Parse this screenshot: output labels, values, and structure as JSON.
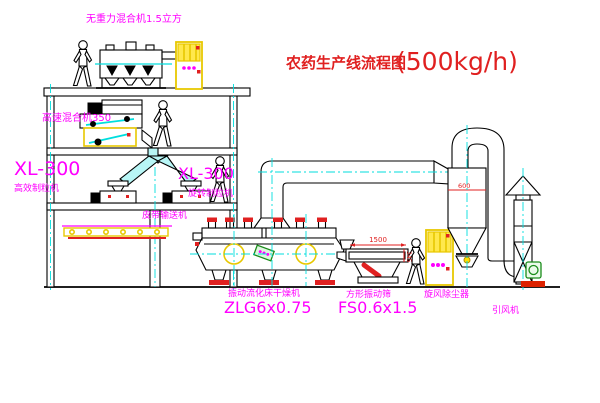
{
  "title": {
    "main": "农药生产线流程图",
    "capacity": "(500kg/h)"
  },
  "equipment_labels": {
    "gravity_free_mixer": "无重力混合机1.5立方",
    "high_speed_mixer": "高速混合机350",
    "granulator_left_model": "XL-300",
    "granulator_left_name": "高效制粒机",
    "granulator_right_model": "XL-300",
    "granulator_right_name": "旋转制粒机",
    "belt_conveyor": "皮带输送机",
    "fluid_bed_dryer_name": "振动流化床干燥机",
    "fluid_bed_dryer_model": "ZLG6x0.75",
    "square_screen_name": "方形振动筛",
    "square_screen_model": "FS0.6x1.5",
    "cyclone_name": "旋风除尘器",
    "fan_name": "引风机"
  },
  "dimensions": {
    "screen_length": "1500",
    "screen_height": "345",
    "cyclone_diameter": "600"
  },
  "colors": {
    "label_magenta": "#ff00ff",
    "title_red": "#e02020",
    "line_black": "#000000",
    "centerline_cyan": "#00dede",
    "equipment_yellow": "#e8c800",
    "motor_green": "#1a8c1a",
    "background": "#ffffff"
  }
}
